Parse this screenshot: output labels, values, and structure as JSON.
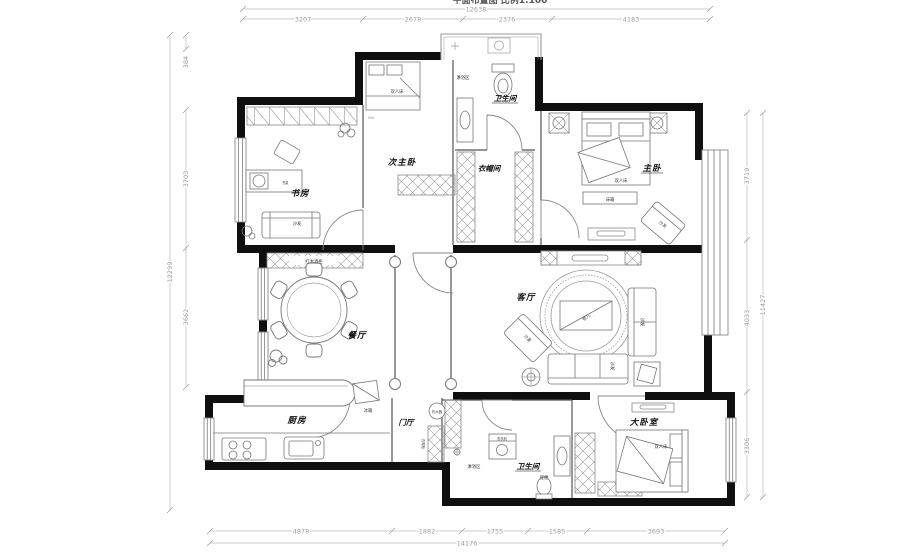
{
  "header": {
    "clipped_title": "平面布置图 比例1:100"
  },
  "dims": {
    "top": {
      "overall": "12638",
      "s1": "3207",
      "s2": "2678",
      "s3": "2376",
      "s4": "4183"
    },
    "bottom": {
      "overall": "14176",
      "s1": "4878",
      "s2": "1882",
      "s3": "1755",
      "s4": "1585",
      "s5": "3693"
    },
    "left": {
      "overall": "12299",
      "s1": "384",
      "s2": "3703",
      "s3": "3662"
    },
    "right": {
      "overall": "11427",
      "s1": "3719",
      "s2": "4033",
      "s3": "3306"
    },
    "bed_width": "550"
  },
  "rooms": {
    "study": "书房",
    "sec_master": "次主卧",
    "bath_top": "卫生间",
    "cloakroom": "衣帽间",
    "master": "主卧",
    "dining": "餐厅",
    "living": "客厅",
    "kitchen": "厨房",
    "foyer": "门厅",
    "bath_bottom": "卫生间",
    "big_bedroom": "大卧室"
  },
  "furniture": {
    "double_bed": "双人床",
    "sofa": "沙发",
    "tea_table": "茶几",
    "bed_bench": "床箱",
    "wine_cabinet": "红木酒柜",
    "fridge": "冰箱",
    "washer": "洗衣机",
    "toilet": "座便",
    "shower_area": "淋浴区",
    "coat_cabinet": "衣帽柜",
    "water_heater": "热水器",
    "desk": "书桌"
  }
}
